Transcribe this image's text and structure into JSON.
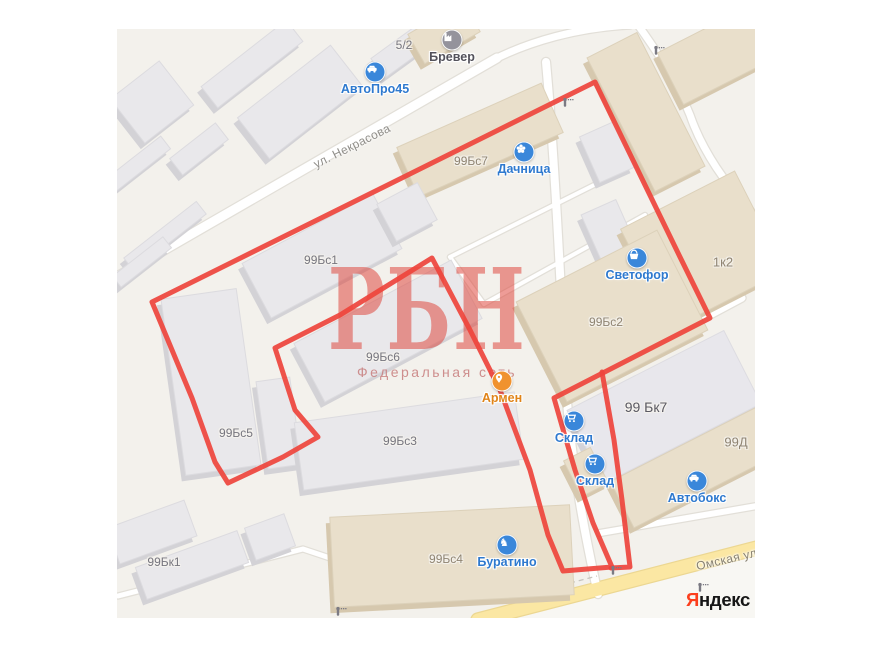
{
  "map": {
    "canvas": {
      "left": 117,
      "top": 29,
      "width": 638,
      "height": 589,
      "bg": "#f3f1ec"
    },
    "palette": {
      "road_fill": "#ffffff",
      "road_casing": "#e2dfd8",
      "yellow_road_fill": "#fbe7a3",
      "yellow_road_casing": "#ecd792",
      "below_yellow_fill": "#f8f7f3",
      "building_gray_face": "#e9e8eb",
      "building_gray_side": "#d3d2d6",
      "building_gray_stroke": "#dcdbdf",
      "building_tan_face": "#e9dfcb",
      "building_tan_side": "#d6c8ae",
      "building_tan_stroke": "#dcd1ba",
      "building_lightgray_face": "#e8e7ec",
      "building_lightgray_side": "#d4d3d9",
      "building_lightgray_stroke": "#dddce1",
      "red_overlay": "#ee443c",
      "poi_blue": "#3a87da",
      "poi_blue_label": "#2e79cf",
      "poi_orange": "#f0922e",
      "poi_orange_label": "#e08419",
      "poi_gray": "#94939c",
      "poi_gray_label": "#53525b",
      "label_gray": "#76757e",
      "label_tan": "#8f8472",
      "label_dark": "#5b5a63",
      "street_label": "#8f8d88",
      "street_label_yellow": "#87806f",
      "dashed_line": "#c6c4be",
      "gate": "#7b7a83"
    },
    "buildings": [
      {
        "name": "bldg-nw-square",
        "cx": 152,
        "cy": 102,
        "w": 62,
        "h": 56,
        "a": -38,
        "k": "gray"
      },
      {
        "name": "bldg-nw-strip",
        "cx": 252,
        "cy": 64,
        "w": 108,
        "h": 27,
        "a": -38,
        "k": "gray"
      },
      {
        "name": "bldg-nw-small",
        "cx": 199,
        "cy": 149,
        "w": 58,
        "h": 21,
        "a": -38,
        "k": "gray"
      },
      {
        "name": "bldg-avtopro45",
        "cx": 300,
        "cy": 102,
        "w": 118,
        "h": 52,
        "a": -38,
        "k": "gray"
      },
      {
        "name": "bldg-w-thin1",
        "cx": 138,
        "cy": 164,
        "w": 70,
        "h": 16,
        "a": -38,
        "k": "gray"
      },
      {
        "name": "bldg-w-thin2",
        "cx": 165,
        "cy": 236,
        "w": 92,
        "h": 16,
        "a": -38,
        "k": "gray"
      },
      {
        "name": "bldg-w-thin3",
        "cx": 142,
        "cy": 262,
        "w": 64,
        "h": 14,
        "a": -38,
        "k": "gray"
      },
      {
        "name": "bldg-5-2",
        "cx": 403,
        "cy": 50,
        "w": 62,
        "h": 24,
        "a": -36,
        "k": "gray"
      },
      {
        "name": "bldg-brever",
        "cx": 444,
        "cy": 33,
        "w": 64,
        "h": 34,
        "a": -30,
        "k": "tan"
      },
      {
        "name": "bldg-99bs7",
        "cx": 480,
        "cy": 140,
        "w": 158,
        "h": 54,
        "a": -24,
        "k": "tan"
      },
      {
        "name": "bldg-99bs1",
        "cx": 322,
        "cy": 256,
        "w": 148,
        "h": 62,
        "a": -28,
        "k": "gray"
      },
      {
        "name": "bldg-yard-small",
        "cx": 407,
        "cy": 212,
        "w": 46,
        "h": 42,
        "a": -28,
        "k": "gray"
      },
      {
        "name": "bldg-99bs6",
        "cx": 388,
        "cy": 331,
        "w": 178,
        "h": 66,
        "a": -28,
        "k": "gray"
      },
      {
        "name": "bldg-99bs5",
        "cx": 211,
        "cy": 382,
        "w": 76,
        "h": 178,
        "a": -8,
        "k": "gray"
      },
      {
        "name": "bldg-99bs5-annex",
        "cx": 279,
        "cy": 423,
        "w": 34,
        "h": 88,
        "a": -8,
        "k": "gray"
      },
      {
        "name": "bldg-99bs3",
        "cx": 409,
        "cy": 441,
        "w": 222,
        "h": 68,
        "a": -8,
        "k": "gray"
      },
      {
        "name": "bldg-99bs4",
        "cx": 452,
        "cy": 556,
        "w": 240,
        "h": 90,
        "a": -3,
        "k": "tan"
      },
      {
        "name": "bldg-ne-tan",
        "cx": 723,
        "cy": 52,
        "w": 118,
        "h": 58,
        "a": -27,
        "k": "tan"
      },
      {
        "name": "bldg-center-tan",
        "cx": 646,
        "cy": 112,
        "w": 56,
        "h": 150,
        "a": -27,
        "k": "tan"
      },
      {
        "name": "bldg-annex1",
        "cx": 607,
        "cy": 152,
        "w": 38,
        "h": 50,
        "a": -24,
        "k": "gray"
      },
      {
        "name": "bldg-annex2",
        "cx": 609,
        "cy": 231,
        "w": 38,
        "h": 52,
        "a": -24,
        "k": "gray"
      },
      {
        "name": "bldg-1k2",
        "cx": 703,
        "cy": 250,
        "w": 128,
        "h": 112,
        "a": -27,
        "k": "tan"
      },
      {
        "name": "bldg-99bs2",
        "cx": 612,
        "cy": 316,
        "w": 158,
        "h": 112,
        "a": -27,
        "k": "tan"
      },
      {
        "name": "bldg-99bk7",
        "cx": 664,
        "cy": 407,
        "w": 176,
        "h": 82,
        "a": -27,
        "k": "lightgray"
      },
      {
        "name": "bldg-99d",
        "cx": 706,
        "cy": 462,
        "w": 188,
        "h": 52,
        "a": -27,
        "k": "tan"
      },
      {
        "name": "bldg-strip-tan",
        "cx": 586,
        "cy": 472,
        "w": 30,
        "h": 40,
        "a": -27,
        "k": "tan"
      },
      {
        "name": "bldg-sw1",
        "cx": 152,
        "cy": 532,
        "w": 82,
        "h": 38,
        "a": -20,
        "k": "gray"
      },
      {
        "name": "bldg-99bk1",
        "cx": 192,
        "cy": 565,
        "w": 108,
        "h": 34,
        "a": -20,
        "k": "gray"
      },
      {
        "name": "bldg-sw2",
        "cx": 270,
        "cy": 537,
        "w": 42,
        "h": 34,
        "a": -20,
        "k": "gray"
      }
    ],
    "building_labels": [
      {
        "text": "5/2",
        "x": 404,
        "y": 45,
        "tone": "gray"
      },
      {
        "text": "99Бс7",
        "x": 471,
        "y": 161,
        "tone": "tan"
      },
      {
        "text": "99Бс1",
        "x": 321,
        "y": 260,
        "tone": "gray"
      },
      {
        "text": "99Бс6",
        "x": 383,
        "y": 357,
        "tone": "gray"
      },
      {
        "text": "99Бс5",
        "x": 236,
        "y": 433,
        "tone": "gray"
      },
      {
        "text": "99Бс3",
        "x": 400,
        "y": 441,
        "tone": "gray"
      },
      {
        "text": "99Бс2",
        "x": 606,
        "y": 322,
        "tone": "tan"
      },
      {
        "text": "1к2",
        "x": 723,
        "y": 262,
        "tone": "tan",
        "size": 13
      },
      {
        "text": "99 Бк7",
        "x": 646,
        "y": 407,
        "tone": "dark",
        "size": 14
      },
      {
        "text": "99Д",
        "x": 736,
        "y": 442,
        "tone": "tan",
        "size": 13
      },
      {
        "text": "99Бс4",
        "x": 446,
        "y": 559,
        "tone": "tan"
      },
      {
        "text": "99Бк1",
        "x": 164,
        "y": 562,
        "tone": "gray"
      }
    ],
    "roads": [
      {
        "name": "nekrasova",
        "d": "M117,277 L497,58",
        "w": 9
      },
      {
        "name": "nekrasova-bend",
        "d": "M497,58 C530,42 575,28 630,25",
        "w": 7
      },
      {
        "name": "north-diagonal",
        "d": "M638,25 C658,53 676,80 690,115 C702,150 726,186 757,218",
        "w": 7
      },
      {
        "name": "inner-vertical",
        "d": "M546,62 C554,150 560,270 566,390 C572,470 586,540 598,594",
        "w": 8
      },
      {
        "name": "svetofor-diagonal",
        "d": "M742,298 L566,392",
        "w": 7
      },
      {
        "name": "yard-loop-top",
        "d": "M450,257 L608,178",
        "w": 4
      },
      {
        "name": "yard-loop-left",
        "d": "M450,257 L484,304",
        "w": 4
      },
      {
        "name": "yard-loop-bottom",
        "d": "M484,304 L645,215",
        "w": 4
      },
      {
        "name": "southwest-path",
        "d": "M118,596 L303,549 L462,602",
        "w": 5
      },
      {
        "name": "south-access",
        "d": "M600,533 L757,506",
        "w": 6
      },
      {
        "name": "omskaya",
        "d": "M478,620 L757,548",
        "w": 13,
        "kind": "yellow"
      }
    ],
    "dashed_lines": [
      "M570,583 L597,576"
    ],
    "red_overlay": {
      "width": 5,
      "paths": [
        "M595,82 L645,185 L680,257 L710,318 L554,398 L562,426 L575,470 L593,523 L612,567 L563,571 L548,535 L530,470 L500,390 L470,330 L432,258 L340,315 L275,348 L295,410 L318,437 L283,457 L228,483 L215,462 L192,398 L152,302 Z",
        "M602,372 L614,440 L622,500 L630,567 L611,568"
      ]
    },
    "gates": [
      [
        565,
        103
      ],
      [
        656,
        51
      ],
      [
        613,
        571
      ],
      [
        700,
        588
      ],
      [
        338,
        612
      ]
    ],
    "pois": [
      {
        "name": "poi-avtopro45",
        "icon": "car",
        "x": 375,
        "y": 72,
        "label": "АвтоПро45",
        "style": "blue"
      },
      {
        "name": "poi-brever",
        "icon": "factory",
        "x": 452,
        "y": 40,
        "label": "Бревер",
        "style": "gray"
      },
      {
        "name": "poi-dachnitsa",
        "icon": "flower",
        "x": 524,
        "y": 152,
        "label": "Дачница",
        "style": "blue"
      },
      {
        "name": "poi-svetofor",
        "icon": "basket",
        "x": 637,
        "y": 258,
        "label": "Светофор",
        "style": "blue"
      },
      {
        "name": "poi-armen",
        "icon": "pin",
        "x": 502,
        "y": 381,
        "label": "Армен",
        "style": "orange"
      },
      {
        "name": "poi-sklad-1",
        "icon": "cart",
        "x": 574,
        "y": 421,
        "label": "Склад",
        "style": "blue"
      },
      {
        "name": "poi-sklad-2",
        "icon": "cart",
        "x": 595,
        "y": 464,
        "label": "Склад",
        "style": "blue"
      },
      {
        "name": "poi-avtoboks",
        "icon": "car",
        "x": 697,
        "y": 481,
        "label": "Автобокс",
        "style": "blue"
      },
      {
        "name": "poi-buratino",
        "icon": "horse",
        "x": 507,
        "y": 545,
        "label": "Буратино",
        "style": "blue"
      }
    ],
    "street_labels": [
      {
        "text": "ул. Некрасова",
        "x": 352,
        "y": 146,
        "angle": -26.5,
        "tone": "street_label"
      },
      {
        "text": "Омская улица",
        "x": 737,
        "y": 557,
        "angle": -13,
        "tone": "street_label_yellow"
      }
    ],
    "watermark": {
      "title": "РБН",
      "subtitle": "Федеральная сеть"
    },
    "logo": {
      "prefix": "Я",
      "rest": "ндекс",
      "prefix_color": "#fc3f1d",
      "rest_color": "#161616"
    }
  }
}
